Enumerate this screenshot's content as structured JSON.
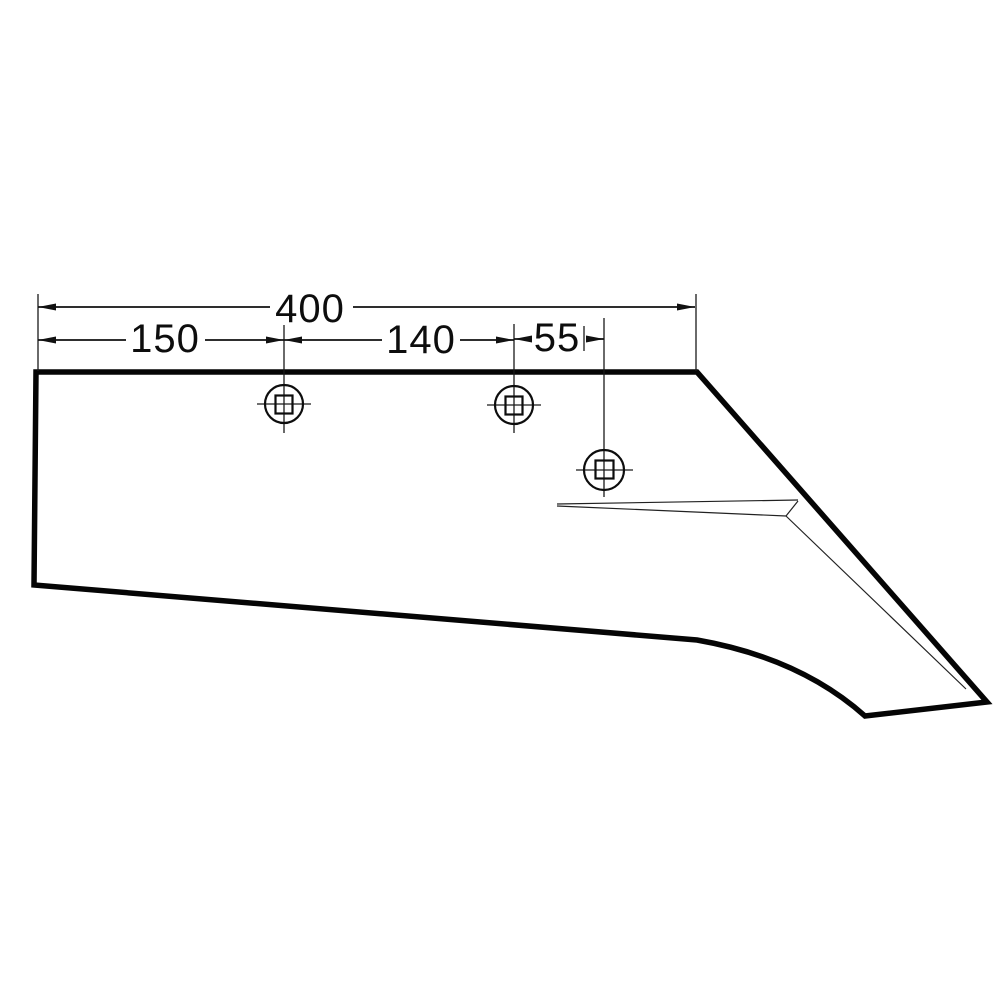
{
  "drawing": {
    "description": "plowshare blade technical drawing",
    "background_color": "#ffffff",
    "line_color": "#000000",
    "hole_count": 3,
    "dimensions": {
      "overall_width": "400",
      "left_edge_to_hole1": "150",
      "hole1_to_hole2": "140",
      "hole2_to_hole3": "55"
    }
  }
}
